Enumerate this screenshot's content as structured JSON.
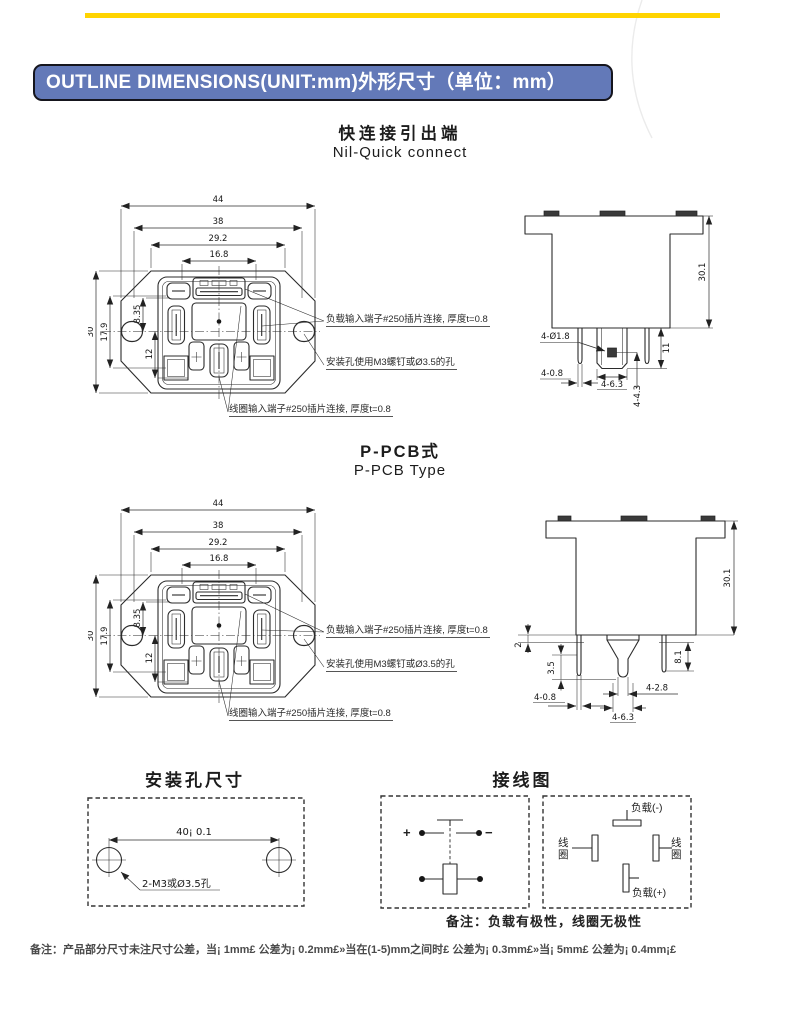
{
  "page": {
    "header_title": "OUTLINE DIMENSIONS(UNIT:mm)外形尺寸（单位：mm）",
    "footer_note": "备注：产品部分尺寸未注尺寸公差，当¡ 1mm£ 公差为¡ 0.2mm£»当在(1-5)mm之间时£ 公差为¡ 0.3mm£»当¡ 5mm£ 公差为¡ 0.4mm¡£",
    "colors": {
      "accent_yellow": "#FFD400",
      "header_bg": "#6379B8",
      "line": "#2B2B2B"
    }
  },
  "quick_connect": {
    "title_zh": "快连接引出端",
    "title_en": "Nil-Quick connect",
    "front_dims": {
      "w44": "44",
      "w38": "38",
      "w29_2": "29.2",
      "w16_8": "16.8",
      "h30": "30",
      "h17_9": "17.9",
      "h8_35": "8.35",
      "h12": "12"
    },
    "side_dims": {
      "h30_1": "30.1",
      "hole": "4-Ø1.8",
      "len11": "11",
      "pin08": "4-0.8",
      "tab63": "4-6.3",
      "pos43": "4-4.3"
    },
    "callout_load": "负载输入端子#250插片连接, 厚度t=0.8",
    "callout_mount": "安装孔使用M3螺钉或Ø3.5的孔",
    "callout_coil": "线圈输入端子#250插片连接, 厚度t=0.8"
  },
  "pcb": {
    "title_zh": "P-PCB式",
    "title_en": "P-PCB Type",
    "front_dims": {
      "w44": "44",
      "w38": "38",
      "w29_2": "29.2",
      "w16_8": "16.8",
      "h30": "30",
      "h17_9": "17.9",
      "h8_35": "8.35",
      "h12": "12"
    },
    "side_dims": {
      "h30_1": "30.1",
      "gap2": "2",
      "tip3_5": "3.5",
      "len8_1": "8.1",
      "pin08": "4-0.8",
      "pin28": "4-2.8",
      "tab63": "4-6.3"
    },
    "callout_load": "负载输入端子#250插片连接, 厚度t=0.8",
    "callout_mount": "安装孔使用M3螺钉或Ø3.5的孔",
    "callout_coil": "线圈输入端子#250插片连接, 厚度t=0.8"
  },
  "mounting": {
    "title": "安装孔尺寸",
    "span_dim": "40¡ 0.1",
    "hole_label": "2-M3或Ø3.5孔"
  },
  "wiring": {
    "title": "接线图",
    "plus": "+",
    "minus": "−",
    "load_neg": "负载(-)",
    "load_pos": "负载(+)",
    "coil": "线圈",
    "polarity_note": "备注：负载有极性，线圈无极性"
  }
}
